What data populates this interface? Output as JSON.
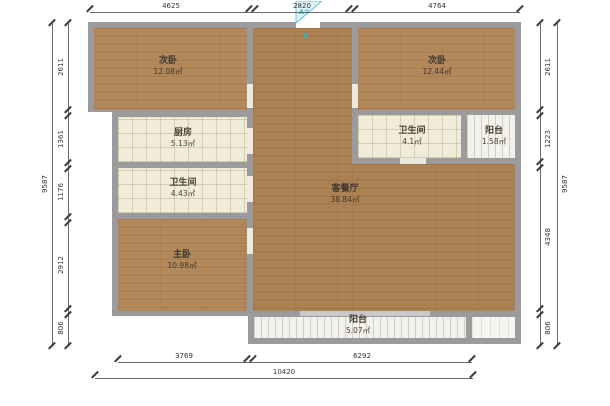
{
  "plan": {
    "title": "apartment-floor-plan",
    "rooms": [
      {
        "id": "bedroom_tl",
        "name": "次卧",
        "area": "12.08㎡"
      },
      {
        "id": "kitchen",
        "name": "厨房",
        "area": "5.13㎡"
      },
      {
        "id": "bath_left",
        "name": "卫生间",
        "area": "4.43㎡"
      },
      {
        "id": "master_bedroom",
        "name": "主卧",
        "area": "10.98㎡"
      },
      {
        "id": "living_dining",
        "name": "客餐厅",
        "area": "38.84㎡"
      },
      {
        "id": "bedroom_tr",
        "name": "次卧",
        "area": "12.44㎡"
      },
      {
        "id": "bath_right",
        "name": "卫生间",
        "area": "4.1㎡"
      },
      {
        "id": "balcony_tr",
        "name": "阳台",
        "area": "1.58㎡"
      },
      {
        "id": "balcony_bottom",
        "name": "阳台",
        "area": "5.07㎡"
      }
    ],
    "entry_marker": {
      "label": "A②",
      "arrow": "▼",
      "color": "#2ab5b5"
    },
    "dimensions": {
      "top": [
        "4625",
        "2820",
        "4764"
      ],
      "left": [
        "2611",
        "1361",
        "1176",
        "2912",
        "806"
      ],
      "left_total": "9587",
      "right": [
        "2611",
        "1223",
        "4348",
        "806"
      ],
      "right_total": "9587",
      "bottom": [
        "3769",
        "6292"
      ],
      "bottom_total": "10420"
    },
    "colors": {
      "wall": "#9b9b9b",
      "wood_floor": "#b2875a",
      "tile_floor": "#f1ecd9",
      "balcony_floor": "#f3f2ec",
      "dimension": "#3c3c3c",
      "entry_accent": "#2ab5b5"
    }
  }
}
